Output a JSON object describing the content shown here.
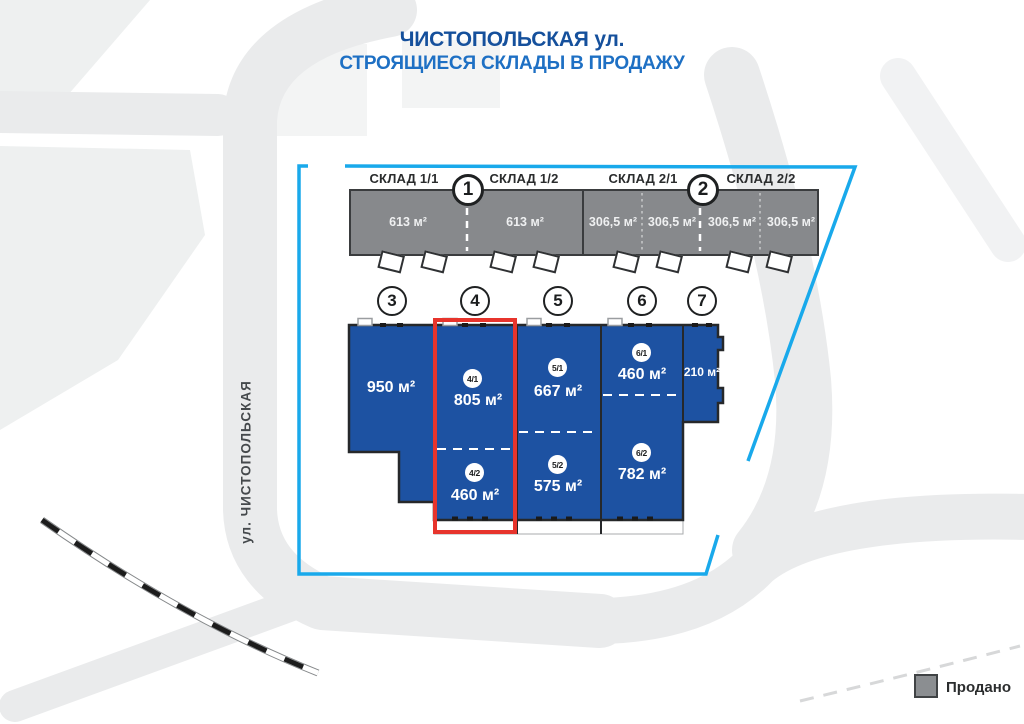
{
  "title": {
    "line1": "ЧИСТОПОЛЬСКАЯ ул.",
    "line2": "СТРОЯЩИЕСЯ СКЛАДЫ В ПРОДАЖУ"
  },
  "street_label": "ул. ЧИСТОПОЛЬСКАЯ",
  "legend": {
    "sold": "Продано"
  },
  "colors": {
    "available_blue": "#1d52a2",
    "sold_gray": "#87898c",
    "boundary_cyan": "#19a9eb",
    "highlight_red": "#e7342c",
    "title_dark_blue": "#15509c",
    "title_light_blue": "#1e70c4"
  },
  "upper_buildings": [
    {
      "number": "1",
      "sections": [
        {
          "name": "СКЛАД 1/1",
          "areas": [
            "613 м²"
          ]
        },
        {
          "name": "СКЛАД 1/2",
          "areas": [
            "613 м²"
          ]
        }
      ]
    },
    {
      "number": "2",
      "sections": [
        {
          "name": "СКЛАД 2/1",
          "areas": [
            "306,5 м²",
            "306,5 м²"
          ]
        },
        {
          "name": "СКЛАД 2/2",
          "areas": [
            "306,5 м²",
            "306,5 м²"
          ]
        }
      ]
    }
  ],
  "lower_buildings": [
    {
      "number": "3",
      "units": [
        {
          "area": "950 м²"
        }
      ]
    },
    {
      "number": "4",
      "highlighted": true,
      "units": [
        {
          "label": "4/1",
          "area": "805 м²"
        },
        {
          "label": "4/2",
          "area": "460 м²"
        }
      ]
    },
    {
      "number": "5",
      "units": [
        {
          "label": "5/1",
          "area": "667 м²"
        },
        {
          "label": "5/2",
          "area": "575 м²"
        }
      ]
    },
    {
      "number": "6",
      "units": [
        {
          "label": "6/1",
          "area": "460 м²"
        },
        {
          "label": "6/2",
          "area": "782 м²"
        }
      ]
    },
    {
      "number": "7",
      "units": [
        {
          "area": "210 м²"
        }
      ]
    }
  ]
}
